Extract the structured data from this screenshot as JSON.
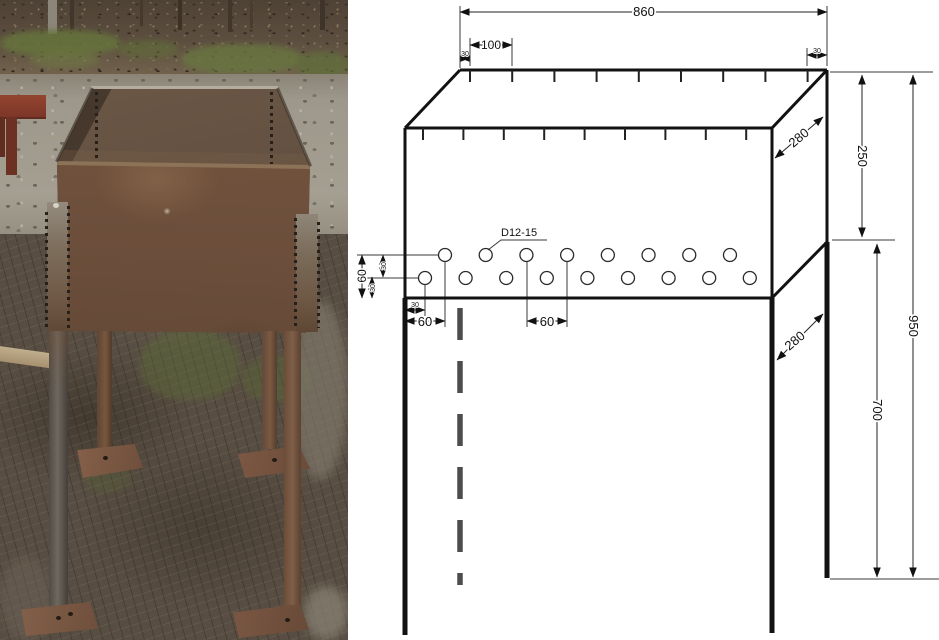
{
  "panels": {
    "photo": {
      "alt": "Photograph of a welded rusty steel brazier box on four angle-iron legs with small foot plates, standing on muddy ground",
      "colors": {
        "rust_panel": "#6b4e3b",
        "rust_light": "#8a6347",
        "steel_leg": "#6f6960",
        "ground_mud": "#574d42",
        "ground_path": "#9e988c",
        "grass": "#66743c",
        "bench_red": "#7c3628"
      }
    },
    "drawing": {
      "background": "#ffffff",
      "line_color": "#111111",
      "hole_callout": "D12-15",
      "dims": {
        "top_width": "860",
        "top_pitch": "100",
        "top_edge_left": "30",
        "top_edge_right": "30",
        "depth_top": "280",
        "box_height": "250",
        "overall_height": "950",
        "leg_height": "700",
        "leg_depth": "280",
        "holes_span_vertical": "60",
        "holes_row_gap": "30",
        "holes_bottom_gap": "30",
        "holes_edge_gap": "30",
        "holes_first_offset": "60",
        "holes_pitch": "60"
      },
      "ticks": {
        "back_count": 9,
        "front_count": 9
      },
      "holes": {
        "top_row_count": 8,
        "bottom_row_count": 9
      }
    }
  }
}
